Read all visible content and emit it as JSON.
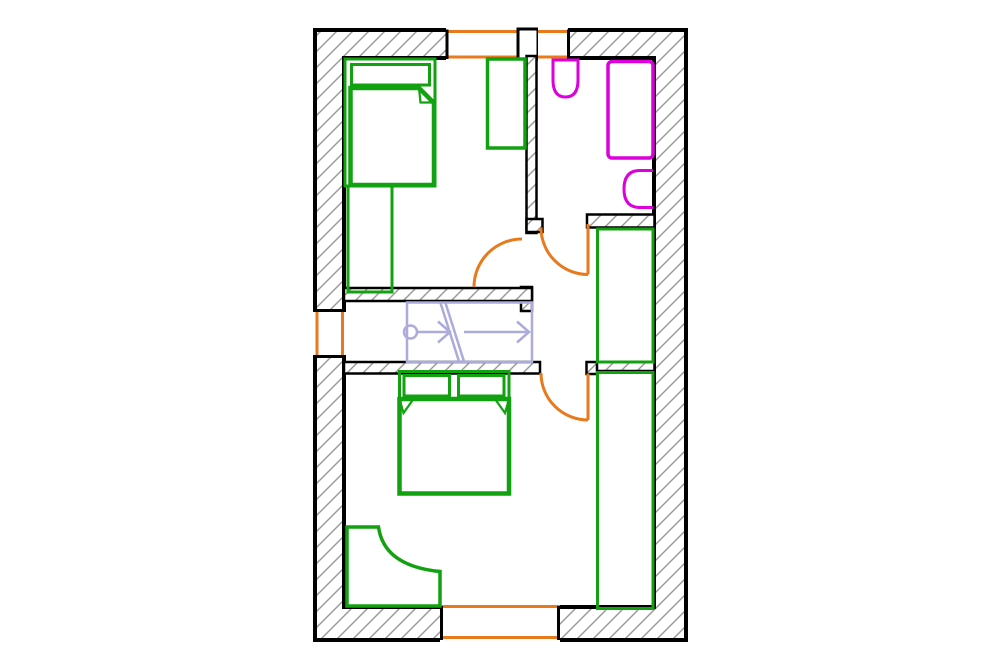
{
  "canvas": {
    "width": 1000,
    "height": 669
  },
  "colors": {
    "wall": "#000000",
    "hatch_line": "#9b9b9b",
    "opening": "#e87a1e",
    "furniture": "#11a111",
    "fixture": "#dc00dc",
    "stairs": "#ababdc",
    "white": "#ffffff"
  },
  "plan": {
    "shapes": [
      {
        "name": "outer-wall",
        "kind": "path",
        "d": "M315,30 H686 V640 H315 Z M344,58 V607 H654 V58 Z",
        "fill": "hatch",
        "stroke": "wall",
        "sw": 4
      },
      {
        "name": "window-top-left-gap",
        "kind": "rect",
        "x": 446,
        "y": 26,
        "w": 72,
        "h": 35,
        "fill": "white"
      },
      {
        "name": "window-top-left-outer-line",
        "kind": "line",
        "x1": 446,
        "y1": 31.5,
        "x2": 518,
        "y2": 31.5,
        "stroke": "opening",
        "sw": 3
      },
      {
        "name": "window-top-left-inner-line",
        "kind": "line",
        "x1": 446,
        "y1": 57,
        "x2": 518,
        "y2": 57,
        "stroke": "opening",
        "sw": 3
      },
      {
        "name": "window-top-left-jamb",
        "kind": "line",
        "x1": 447,
        "y1": 29.5,
        "x2": 447,
        "y2": 59,
        "stroke": "wall",
        "sw": 3
      },
      {
        "name": "window-top-pier",
        "kind": "rect",
        "x": 518,
        "y": 29,
        "w": 20,
        "h": 30,
        "fill": "white",
        "stroke": "wall",
        "sw": 3
      },
      {
        "name": "window-top-right-gap",
        "kind": "rect",
        "x": 538,
        "y": 26,
        "w": 30,
        "h": 35,
        "fill": "white"
      },
      {
        "name": "window-top-right-outer-line",
        "kind": "line",
        "x1": 538,
        "y1": 31.5,
        "x2": 568,
        "y2": 31.5,
        "stroke": "opening",
        "sw": 3
      },
      {
        "name": "window-top-right-inner-line",
        "kind": "line",
        "x1": 538,
        "y1": 57,
        "x2": 568,
        "y2": 57,
        "stroke": "opening",
        "sw": 3
      },
      {
        "name": "window-top-right-jamb",
        "kind": "line",
        "x1": 568.5,
        "y1": 29.5,
        "x2": 568.5,
        "y2": 59,
        "stroke": "wall",
        "sw": 3
      },
      {
        "name": "window-left-gap",
        "kind": "rect",
        "x": 312,
        "y": 309,
        "w": 34,
        "h": 49,
        "fill": "white"
      },
      {
        "name": "window-left-outer-line",
        "kind": "line",
        "x1": 317,
        "y1": 309,
        "x2": 317,
        "y2": 358,
        "stroke": "opening",
        "sw": 3
      },
      {
        "name": "window-left-inner-line",
        "kind": "line",
        "x1": 342.5,
        "y1": 309,
        "x2": 342.5,
        "y2": 358,
        "stroke": "opening",
        "sw": 3
      },
      {
        "name": "window-left-jamb-north",
        "kind": "line",
        "x1": 313,
        "y1": 310.5,
        "x2": 346,
        "y2": 310.5,
        "stroke": "wall",
        "sw": 3
      },
      {
        "name": "window-left-jamb-south",
        "kind": "line",
        "x1": 313,
        "y1": 356.5,
        "x2": 346,
        "y2": 356.5,
        "stroke": "wall",
        "sw": 3
      },
      {
        "name": "window-bottom-gap",
        "kind": "rect",
        "x": 440,
        "y": 604,
        "w": 120,
        "h": 38,
        "fill": "white"
      },
      {
        "name": "window-bottom-inner-line",
        "kind": "line",
        "x1": 440,
        "y1": 606.5,
        "x2": 560,
        "y2": 606.5,
        "stroke": "opening",
        "sw": 3
      },
      {
        "name": "window-bottom-outer-line",
        "kind": "line",
        "x1": 440,
        "y1": 637.5,
        "x2": 560,
        "y2": 637.5,
        "stroke": "opening",
        "sw": 3
      },
      {
        "name": "window-bottom-jamb-west",
        "kind": "line",
        "x1": 441.5,
        "y1": 606,
        "x2": 441.5,
        "y2": 640,
        "stroke": "wall",
        "sw": 3
      },
      {
        "name": "window-bottom-jamb-east",
        "kind": "line",
        "x1": 558.5,
        "y1": 606,
        "x2": 558.5,
        "y2": 640,
        "stroke": "wall",
        "sw": 3
      },
      {
        "name": "wall-bedroom1-door-jamb",
        "kind": "rect",
        "x": 521,
        "y": 287,
        "w": 11,
        "h": 24,
        "fill": "hatch",
        "stroke": "wall",
        "sw": 2.5
      },
      {
        "name": "wall-divider-vertical",
        "kind": "rect",
        "x": 526.5,
        "y": 56,
        "w": 10,
        "h": 177,
        "fill": "hatch",
        "stroke": "wall",
        "sw": 2.5
      },
      {
        "name": "wall-bathroom-stub",
        "kind": "rect",
        "x": 526.5,
        "y": 219,
        "w": 16,
        "h": 13,
        "fill": "hatch",
        "stroke": "wall",
        "sw": 2.5
      },
      {
        "name": "wall-bathroom-south",
        "kind": "rect",
        "x": 587,
        "y": 214.5,
        "w": 67.5,
        "h": 13,
        "fill": "hatch",
        "stroke": "wall",
        "sw": 2.5
      },
      {
        "name": "wall-corridor-north",
        "kind": "rect",
        "x": 344,
        "y": 288,
        "w": 188,
        "h": 13,
        "fill": "hatch",
        "stroke": "wall",
        "sw": 2.5
      },
      {
        "name": "wall-corridor-south",
        "kind": "rect",
        "x": 344,
        "y": 362,
        "w": 196,
        "h": 11.5,
        "fill": "hatch",
        "stroke": "wall",
        "sw": 2.5
      },
      {
        "name": "wall-bedroom2-door-stub",
        "kind": "rect",
        "x": 586.5,
        "y": 362,
        "w": 11,
        "h": 12,
        "fill": "hatch",
        "stroke": "wall",
        "sw": 2.5
      },
      {
        "name": "wall-behind-wardrobe",
        "kind": "rect",
        "x": 597,
        "y": 362,
        "w": 57.5,
        "h": 9,
        "fill": "hatch",
        "stroke": "wall",
        "sw": 2.5
      },
      {
        "name": "stairs-outline",
        "kind": "rect",
        "x": 407,
        "y": 302.5,
        "w": 125,
        "h": 59.5,
        "stroke": "stairs",
        "sw": 2.5
      },
      {
        "name": "stairs-start-circle",
        "kind": "circle",
        "cx": 410.5,
        "cy": 332,
        "r": 6.5,
        "stroke": "stairs",
        "sw": 2.5
      },
      {
        "name": "stairs-run-line-1",
        "kind": "line",
        "x1": 417,
        "y1": 332,
        "x2": 450,
        "y2": 332,
        "stroke": "stairs",
        "sw": 2.5
      },
      {
        "name": "stairs-arrow-1",
        "kind": "path",
        "d": "M438,321.5 L450,332 L438,342.5",
        "stroke": "stairs",
        "sw": 2.5
      },
      {
        "name": "stairs-break-line-1",
        "kind": "line",
        "x1": 440.5,
        "y1": 303,
        "x2": 459,
        "y2": 361.5,
        "stroke": "stairs",
        "sw": 2.5
      },
      {
        "name": "stairs-break-line-2",
        "kind": "line",
        "x1": 445.5,
        "y1": 303,
        "x2": 464,
        "y2": 361.5,
        "stroke": "stairs",
        "sw": 2.5
      },
      {
        "name": "stairs-run-line-2",
        "kind": "line",
        "x1": 464,
        "y1": 332,
        "x2": 529,
        "y2": 332,
        "stroke": "stairs",
        "sw": 2.5
      },
      {
        "name": "stairs-arrow-2",
        "kind": "path",
        "d": "M517,321.5 L529,332 L517,342.5",
        "stroke": "stairs",
        "sw": 2.5
      },
      {
        "name": "bed-single-frame",
        "kind": "rect",
        "x": 345,
        "y": 59,
        "w": 90,
        "h": 127,
        "stroke": "furniture",
        "sw": 3
      },
      {
        "name": "bed-single-pillow",
        "kind": "rect",
        "x": 351.5,
        "y": 64.5,
        "w": 78,
        "h": 20.5,
        "stroke": "furniture",
        "sw": 3
      },
      {
        "name": "bed-single-blanket",
        "kind": "path",
        "d": "M350.5,88 H419 L434,103 V185 H350.5 Z",
        "stroke": "furniture",
        "sw": 4.5
      },
      {
        "name": "bed-single-blanket-fold",
        "kind": "path",
        "d": "M419,88 L433,102.5 L420.5,102.5 Z",
        "stroke": "furniture",
        "sw": 2.2
      },
      {
        "name": "dresser-bedroom1",
        "kind": "rect",
        "x": 348,
        "y": 186,
        "w": 44,
        "h": 106,
        "stroke": "furniture",
        "sw": 3
      },
      {
        "name": "wardrobe-bedroom1",
        "kind": "rect",
        "x": 487.5,
        "y": 59,
        "w": 37.5,
        "h": 89,
        "stroke": "furniture",
        "sw": 3.5
      },
      {
        "name": "wardrobe-hall",
        "kind": "rect",
        "x": 597.5,
        "y": 229,
        "w": 55.5,
        "h": 133,
        "stroke": "furniture",
        "sw": 3
      },
      {
        "name": "wardrobe-bedroom2",
        "kind": "rect",
        "x": 597.5,
        "y": 372.5,
        "w": 55.5,
        "h": 236,
        "stroke": "furniture",
        "sw": 3
      },
      {
        "name": "bed-double-frame",
        "kind": "rect",
        "x": 399.5,
        "y": 371.5,
        "w": 109.5,
        "h": 122,
        "stroke": "furniture",
        "sw": 3
      },
      {
        "name": "bed-double-pillow-left",
        "kind": "rect",
        "x": 404,
        "y": 375.5,
        "w": 45.5,
        "h": 20.5,
        "stroke": "furniture",
        "sw": 3
      },
      {
        "name": "bed-double-pillow-right",
        "kind": "rect",
        "x": 458.5,
        "y": 375.5,
        "w": 45.5,
        "h": 20.5,
        "stroke": "furniture",
        "sw": 3
      },
      {
        "name": "bed-double-blanket",
        "kind": "rect",
        "x": 399.5,
        "y": 399,
        "w": 109.5,
        "h": 94.5,
        "stroke": "furniture",
        "sw": 4.5
      },
      {
        "name": "bed-double-fold-left",
        "kind": "path",
        "d": "M399.5,399 L413.5,399 L403.5,413 Z",
        "stroke": "furniture",
        "sw": 2.2
      },
      {
        "name": "bed-double-fold-right",
        "kind": "path",
        "d": "M509,399 L495,399 L505,413 Z",
        "stroke": "furniture",
        "sw": 2.2
      },
      {
        "name": "desk-corner",
        "kind": "path",
        "d": "M347,527 H378.5 Q384,566 440,571.5 V606 H347 Z",
        "stroke": "furniture",
        "sw": 3.5
      },
      {
        "name": "bathroom-sink",
        "kind": "path",
        "d": "M553,60 H578 V80 Q578,97 565.5,97 Q553,97 553,80 Z",
        "stroke": "fixture",
        "sw": 3
      },
      {
        "name": "bathroom-bathtub",
        "kind": "rect",
        "x": 608,
        "y": 61.5,
        "w": 45,
        "h": 96.5,
        "rx": 4,
        "stroke": "fixture",
        "sw": 3.5
      },
      {
        "name": "bathroom-toilet",
        "kind": "path",
        "d": "M653,170.5 H640 Q624,170.5 624,189 Q624,207.5 640,207.5 H653",
        "stroke": "fixture",
        "sw": 3
      },
      {
        "name": "door-bedroom1-arc",
        "kind": "path",
        "d": "M474,287 A48,48 0 0 1 522,239",
        "stroke": "opening",
        "sw": 3
      },
      {
        "name": "door-bathroom-leaf",
        "kind": "line",
        "x1": 588,
        "y1": 224,
        "x2": 588,
        "y2": 274.5,
        "stroke": "opening",
        "sw": 3
      },
      {
        "name": "door-bathroom-arc",
        "kind": "path",
        "d": "M541,227.5 A47,47 0 0 0 588,274.5",
        "stroke": "opening",
        "sw": 3
      },
      {
        "name": "door-bedroom2-leaf",
        "kind": "line",
        "x1": 588,
        "y1": 373.5,
        "x2": 588,
        "y2": 420,
        "stroke": "opening",
        "sw": 3
      },
      {
        "name": "door-bedroom2-arc",
        "kind": "path",
        "d": "M541,373 A47,47 0 0 0 588,420",
        "stroke": "opening",
        "sw": 3
      }
    ]
  }
}
